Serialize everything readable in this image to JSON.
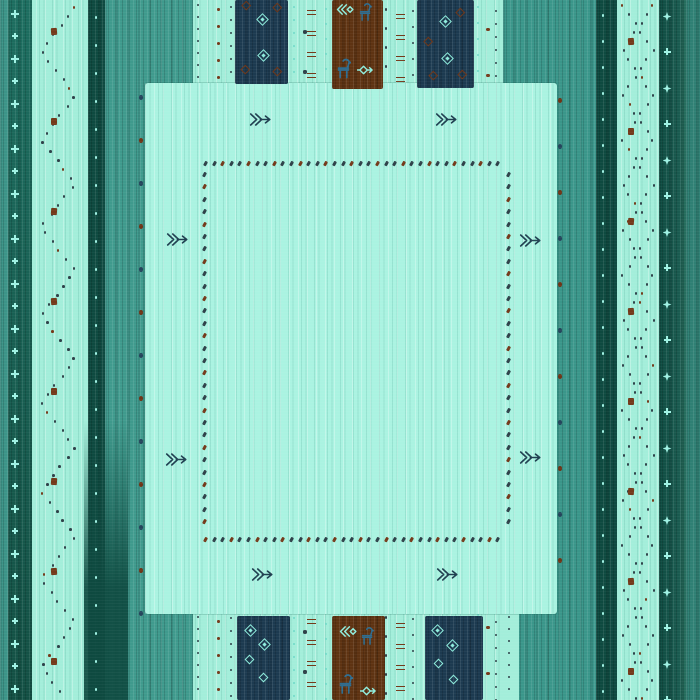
{
  "description": "Teal tribal gabbeh-style rug: vertical striped borders, large mint center field with dotted inner border, arrow motifs, navy and brown blocks with diamond and animal motifs at top and bottom",
  "palette": {
    "base": "#a3eeda",
    "field": "#aaf3e1",
    "medium": "#3f9a8d",
    "medium2": "#3a968a",
    "dark": "#0e4a40",
    "navy": "#1c3a50",
    "brown": "#5e3312",
    "dotDark": "#2e4149",
    "dotBrown": "#74391a",
    "tealLight": "#a0f2e4",
    "tealDot": "#6fd8c8",
    "animalBlue": "#2d6d91",
    "motifLight": "#8feede",
    "arrowDark": "#1f3f50",
    "edgeNavy": "#24455c",
    "edgeBrown": "#6e3517"
  },
  "stripes": [
    {
      "name": "base-field",
      "x": 0,
      "y": 0,
      "w": 700,
      "h": 700,
      "color": "base",
      "tex": "texl"
    },
    {
      "name": "stripe-edge-left",
      "x": 0,
      "y": 0,
      "w": 8,
      "h": 700,
      "color": "#3c9488",
      "tex": "texd"
    },
    {
      "name": "stripe-dark-left",
      "x": 8,
      "y": 0,
      "w": 24,
      "h": 700,
      "grad": "linear-gradient(180deg,#1d6e60,#135044)",
      "tex": "texd"
    },
    {
      "name": "stripe-dark-a",
      "x": 88,
      "y": 0,
      "w": 17,
      "h": 700,
      "color": "dark",
      "tex": "texd"
    },
    {
      "name": "stripe-medium-left",
      "x": 105,
      "y": 0,
      "w": 88,
      "h": 700,
      "color": "medium",
      "tex": "texd"
    },
    {
      "name": "stripe-medium-right",
      "x": 503,
      "y": 0,
      "w": 93,
      "h": 700,
      "color": "medium2",
      "tex": "texd"
    },
    {
      "name": "stripe-dark-b",
      "x": 596,
      "y": 0,
      "w": 21,
      "h": 700,
      "color": "dark",
      "tex": "texd"
    },
    {
      "name": "stripe-dark-right",
      "x": 659,
      "y": 0,
      "w": 27,
      "h": 700,
      "grad": "linear-gradient(90deg,#0f4c42,#1a5b50 75%,#27705f)",
      "tex": "texd"
    },
    {
      "name": "stripe-edge-right",
      "x": 686,
      "y": 0,
      "w": 14,
      "h": 700,
      "color": "#2f8074",
      "tex": "texd"
    }
  ],
  "overlays": [
    {
      "name": "dark-stripe-bottom-flare",
      "x": 84,
      "y": 420,
      "w": 44,
      "h": 280,
      "grad": "linear-gradient(180deg,rgba(14,74,64,0),rgba(14,74,64,0.92) 60%)"
    },
    {
      "name": "light-patch-bottom-right",
      "x": 503,
      "y": 612,
      "w": 16,
      "h": 88,
      "color": "base"
    }
  ],
  "zigzags": [
    {
      "cx": 57,
      "amp": 17,
      "period": 88,
      "y0": 6,
      "y1": 696,
      "step": 9,
      "color": "dotDark",
      "brownEvery": 9
    },
    {
      "cx": 637,
      "amp": 15,
      "period": 90,
      "y0": 4,
      "y1": 698,
      "step": 9,
      "color": "dotDark",
      "brownEvery": 8,
      "phase": 0
    },
    {
      "cx": 637,
      "amp": 15,
      "period": 90,
      "y0": 4,
      "y1": 698,
      "step": 9,
      "color": "dotDark",
      "brownEvery": 11,
      "phase": 0.5
    }
  ],
  "columns": [
    {
      "type": "cross",
      "x": 15,
      "y0": 10,
      "y1": 696,
      "step": 22.5,
      "color": "tealLight",
      "sizes": [
        8,
        6
      ]
    },
    {
      "type": "dot",
      "x": 96,
      "y0": 16,
      "y1": 700,
      "step": 28,
      "color": "tealLight",
      "size": 2.6
    },
    {
      "type": "dot",
      "x": 141,
      "y0": 95,
      "y1": 612,
      "step": 43,
      "colors": [
        "edgeNavy",
        "edgeBrown"
      ],
      "size": 4.2,
      "sizeH": 5
    },
    {
      "type": "dot",
      "x": 198,
      "y0": 4,
      "y1": 700,
      "step": 12,
      "color": "dotDark",
      "size": 2.4
    },
    {
      "type": "dot",
      "x": 218,
      "y0": 8,
      "y1": 700,
      "step": 17,
      "color": "dotBrown",
      "size": 3
    },
    {
      "type": "dot",
      "x": 231,
      "y0": 6,
      "y1": 700,
      "step": 13,
      "color": "dotDark",
      "size": 2.2
    },
    {
      "type": "dot",
      "x": 294,
      "y0": 6,
      "y1": 700,
      "step": 13,
      "color": "tealDot",
      "size": 2.4
    },
    {
      "type": "dot",
      "x": 305,
      "y0": 30,
      "y1": 700,
      "step": 40,
      "color": "dotDark",
      "size": 3.5
    },
    {
      "type": "dash",
      "x": 311,
      "y0": 10,
      "y1": 700,
      "step": 21,
      "color": "dotBrown"
    },
    {
      "type": "dot",
      "x": 326,
      "y0": 8,
      "y1": 700,
      "step": 15,
      "color": "tealDot",
      "size": 2.2
    },
    {
      "type": "dot",
      "x": 386,
      "y0": 8,
      "y1": 700,
      "step": 19,
      "color": "dotDark",
      "size": 2.6
    },
    {
      "type": "dash",
      "x": 400,
      "y0": 14,
      "y1": 700,
      "step": 21,
      "color": "dotBrown"
    },
    {
      "type": "dot",
      "x": 413,
      "y0": 10,
      "y1": 700,
      "step": 16,
      "color": "dotDark",
      "size": 2.4
    },
    {
      "type": "dot",
      "x": 478,
      "y0": 6,
      "y1": 700,
      "step": 16,
      "color": "tealDot",
      "size": 2.4
    },
    {
      "type": "dot",
      "x": 488,
      "y0": 28,
      "y1": 700,
      "step": 46,
      "color": "dotBrown",
      "size": 3.4
    },
    {
      "type": "dot",
      "x": 496,
      "y0": 10,
      "y1": 700,
      "step": 13,
      "color": "dotDark",
      "size": 2.2
    },
    {
      "type": "dot",
      "x": 509,
      "y0": 616,
      "y1": 700,
      "step": 12,
      "color": "dotDark",
      "size": 2.4
    },
    {
      "type": "dot",
      "x": 560,
      "y0": 98,
      "y1": 560,
      "step": 46,
      "colors": [
        "edgeBrown",
        "edgeNavy"
      ],
      "size": 4.2,
      "sizeH": 5
    },
    {
      "type": "dot",
      "x": 603,
      "y0": 14,
      "y1": 700,
      "step": 26,
      "color": "tealLight",
      "size": 2.6
    },
    {
      "type": "square",
      "x": 54,
      "y0": 28,
      "y1": 700,
      "step": 90,
      "color": "dotBrown",
      "size": 6
    },
    {
      "type": "square",
      "x": 631,
      "y0": 38,
      "y1": 700,
      "step": 90,
      "color": "dotBrown",
      "size": 6
    },
    {
      "type": "sparkle-cross",
      "x": 667,
      "y0": 12,
      "y1": 700,
      "step": 36,
      "color": "tealLight",
      "sizes": [
        9,
        7
      ]
    }
  ],
  "center_field": {
    "x": 145,
    "y": 83,
    "w": 412,
    "h": 531,
    "color": "field"
  },
  "dotted_border": {
    "x": 203,
    "y": 161,
    "w": 304,
    "h": 376,
    "hstep": 8.6,
    "vstep": 12.4,
    "dot": {
      "w": 2.6,
      "h": 5.2
    },
    "pattern": [
      "dotDark",
      "dotDark",
      "dotBrown"
    ]
  },
  "blocks": [
    {
      "name": "block-navy-top-left",
      "x": 235,
      "y": 0,
      "w": 53,
      "h": 84,
      "color": "navy"
    },
    {
      "name": "block-brown-top",
      "x": 332,
      "y": 0,
      "w": 51,
      "h": 89,
      "color": "brown"
    },
    {
      "name": "block-navy-top-right",
      "x": 417,
      "y": 0,
      "w": 57,
      "h": 88,
      "color": "navy"
    },
    {
      "name": "block-navy-bottom-left",
      "x": 237,
      "y": 616,
      "w": 53,
      "h": 84,
      "color": "navy"
    },
    {
      "name": "block-brown-bottom",
      "x": 332,
      "y": 616,
      "w": 53,
      "h": 84,
      "color": "brown"
    },
    {
      "name": "block-navy-bottom-right",
      "x": 425,
      "y": 616,
      "w": 58,
      "h": 84,
      "color": "navy"
    }
  ],
  "diamonds": [
    {
      "x": 262,
      "y": 19,
      "v": "nested"
    },
    {
      "x": 263,
      "y": 55,
      "v": "nested"
    },
    {
      "x": 246,
      "y": 5,
      "v": "brown"
    },
    {
      "x": 277,
      "y": 7,
      "v": "brown"
    },
    {
      "x": 245,
      "y": 69,
      "v": "brown"
    },
    {
      "x": 277,
      "y": 71,
      "v": "brown"
    },
    {
      "x": 445,
      "y": 21,
      "v": "nested"
    },
    {
      "x": 447,
      "y": 58,
      "v": "nested"
    },
    {
      "x": 460,
      "y": 12,
      "v": "brown"
    },
    {
      "x": 428,
      "y": 41,
      "v": "brown"
    },
    {
      "x": 433,
      "y": 75,
      "v": "brown"
    },
    {
      "x": 462,
      "y": 74,
      "v": "brown"
    },
    {
      "x": 250,
      "y": 630,
      "v": "nested"
    },
    {
      "x": 264,
      "y": 644,
      "v": "nested"
    },
    {
      "x": 249,
      "y": 659,
      "v": "hollow"
    },
    {
      "x": 263,
      "y": 677,
      "v": "hollow"
    },
    {
      "x": 437,
      "y": 630,
      "v": "nested"
    },
    {
      "x": 452,
      "y": 645,
      "v": "nested"
    },
    {
      "x": 438,
      "y": 663,
      "v": "hollow"
    },
    {
      "x": 453,
      "y": 679,
      "v": "hollow"
    }
  ],
  "glyphs": [
    {
      "sym": "arrow",
      "x": 249,
      "y": 111,
      "w": 22,
      "h": 17,
      "color": "arrowDark"
    },
    {
      "sym": "arrow",
      "x": 435,
      "y": 111,
      "w": 22,
      "h": 17,
      "color": "arrowDark"
    },
    {
      "sym": "arrow",
      "x": 166,
      "y": 231,
      "w": 22,
      "h": 17,
      "color": "arrowDark"
    },
    {
      "sym": "arrow",
      "x": 519,
      "y": 232,
      "w": 22,
      "h": 17,
      "color": "arrowDark"
    },
    {
      "sym": "arrow",
      "x": 165,
      "y": 451,
      "w": 22,
      "h": 17,
      "color": "arrowDark"
    },
    {
      "sym": "arrow",
      "x": 519,
      "y": 449,
      "w": 22,
      "h": 17,
      "color": "arrowDark"
    },
    {
      "sym": "arrow",
      "x": 251,
      "y": 566,
      "w": 22,
      "h": 17,
      "color": "arrowDark"
    },
    {
      "sym": "arrow",
      "x": 436,
      "y": 566,
      "w": 22,
      "h": 17,
      "color": "arrowDark"
    },
    {
      "sym": "arrowleft",
      "x": 335,
      "y": 3,
      "w": 19,
      "h": 13,
      "color": "motifLight"
    },
    {
      "sym": "animal",
      "x": 359,
      "y": 3,
      "w": 13,
      "h": 18,
      "color": "animalBlue"
    },
    {
      "sym": "animal",
      "x": 337,
      "y": 58,
      "w": 14,
      "h": 21,
      "color": "animalBlue"
    },
    {
      "sym": "arrowdia",
      "x": 356,
      "y": 63,
      "w": 17,
      "h": 14,
      "color": "motifLight"
    },
    {
      "sym": "arrowleft",
      "x": 338,
      "y": 625,
      "w": 19,
      "h": 13,
      "color": "motifLight"
    },
    {
      "sym": "animal",
      "x": 361,
      "y": 627,
      "w": 13,
      "h": 18,
      "color": "animalBlue"
    },
    {
      "sym": "animal",
      "x": 339,
      "y": 674,
      "w": 14,
      "h": 20,
      "color": "animalBlue"
    },
    {
      "sym": "arrowdia",
      "x": 359,
      "y": 684,
      "w": 17,
      "h": 14,
      "color": "motifLight"
    }
  ]
}
